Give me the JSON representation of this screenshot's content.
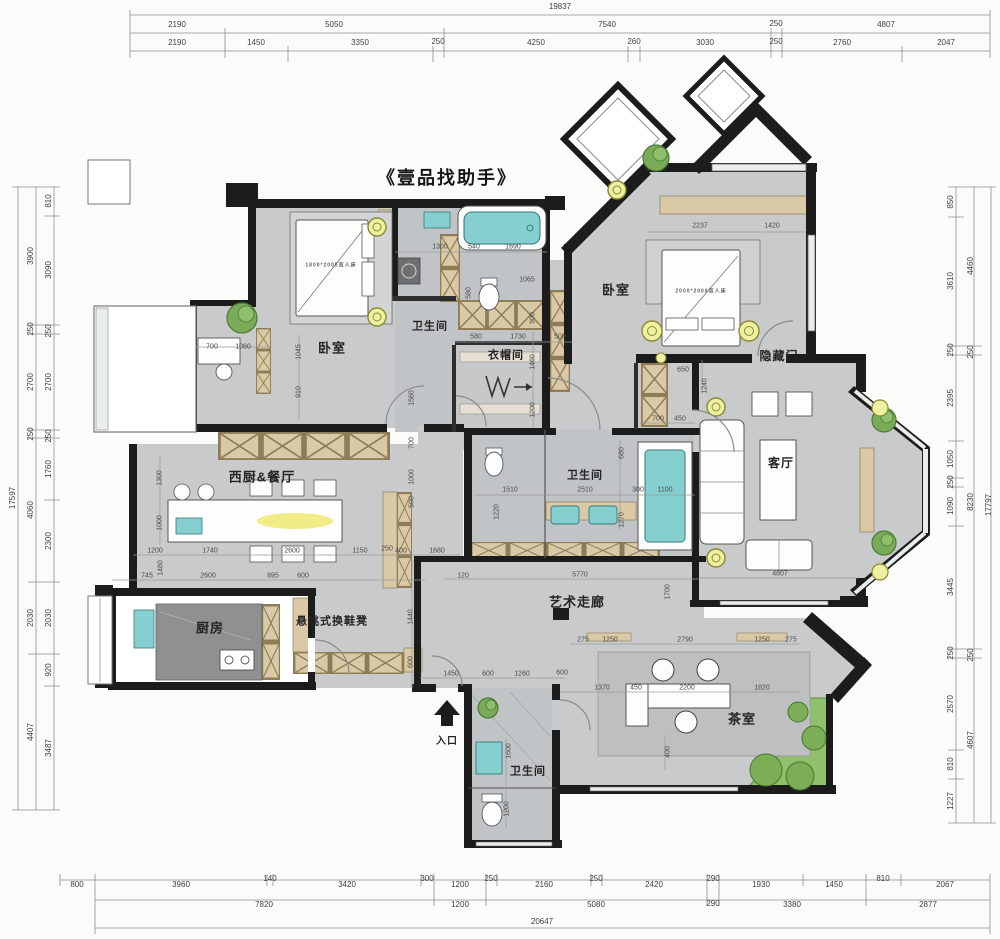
{
  "title": {
    "text": "《壹品找助手》"
  },
  "colors": {
    "wall": "#1c1c1c",
    "floor": "#c8cacb",
    "bath_floor": "#c0c4c6",
    "cabinet": "#d9c9a6",
    "fixture_teal": "#85d0cf",
    "lamp_yellow": "#eef0a2",
    "plant_green": "#79ab58",
    "garden_green": "#90c06c",
    "glow_yellow": "#f0eb7e"
  },
  "rooms": [
    {
      "t": "卧室",
      "x": 332,
      "y": 348,
      "fs": 13
    },
    {
      "t": "卫生间",
      "x": 430,
      "y": 327,
      "fs": 11
    },
    {
      "t": "衣帽间",
      "x": 506,
      "y": 356,
      "fs": 11
    },
    {
      "t": "卧室",
      "x": 616,
      "y": 290,
      "fs": 13
    },
    {
      "t": "隐藏门",
      "x": 779,
      "y": 356,
      "fs": 12
    },
    {
      "t": "客厅",
      "x": 781,
      "y": 463,
      "fs": 12
    },
    {
      "t": "卫生间",
      "x": 585,
      "y": 476,
      "fs": 11
    },
    {
      "t": "西厨&餐厅",
      "x": 262,
      "y": 477,
      "fs": 13
    },
    {
      "t": "厨房",
      "x": 210,
      "y": 628,
      "fs": 13
    },
    {
      "t": "悬挑式换鞋凳",
      "x": 332,
      "y": 622,
      "fs": 11
    },
    {
      "t": "艺术走廊",
      "x": 577,
      "y": 602,
      "fs": 13
    },
    {
      "t": "茶室",
      "x": 742,
      "y": 719,
      "fs": 13
    },
    {
      "t": "卫生间",
      "x": 528,
      "y": 772,
      "fs": 11
    },
    {
      "t": "入口",
      "x": 447,
      "y": 742,
      "fs": 10
    },
    {
      "t": "1800*2000双人床",
      "x": 331,
      "y": 266,
      "fs": 5,
      "c": "#5a5a5a"
    },
    {
      "t": "2000*2000双人床",
      "x": 701,
      "y": 292,
      "fs": 5,
      "c": "#5a5a5a"
    }
  ],
  "outer_dims": [
    {
      "t": "19837",
      "x": 560,
      "y": 7
    },
    {
      "t": "2190",
      "x": 177,
      "y": 25
    },
    {
      "t": "5050",
      "x": 334,
      "y": 25
    },
    {
      "t": "7540",
      "x": 607,
      "y": 25
    },
    {
      "t": "250",
      "x": 776,
      "y": 24
    },
    {
      "t": "4807",
      "x": 886,
      "y": 25
    },
    {
      "t": "2190",
      "x": 177,
      "y": 43
    },
    {
      "t": "1450",
      "x": 256,
      "y": 43
    },
    {
      "t": "3350",
      "x": 360,
      "y": 43
    },
    {
      "t": "250",
      "x": 438,
      "y": 42
    },
    {
      "t": "4250",
      "x": 536,
      "y": 43
    },
    {
      "t": "260",
      "x": 634,
      "y": 42
    },
    {
      "t": "3030",
      "x": 705,
      "y": 43
    },
    {
      "t": "250",
      "x": 776,
      "y": 42
    },
    {
      "t": "2760",
      "x": 842,
      "y": 43
    },
    {
      "t": "2047",
      "x": 946,
      "y": 43
    },
    {
      "t": "800",
      "x": 77,
      "y": 885
    },
    {
      "t": "3960",
      "x": 181,
      "y": 885
    },
    {
      "t": "140",
      "x": 270,
      "y": 879
    },
    {
      "t": "3420",
      "x": 347,
      "y": 885
    },
    {
      "t": "300",
      "x": 427,
      "y": 879
    },
    {
      "t": "1200",
      "x": 460,
      "y": 885
    },
    {
      "t": "250",
      "x": 491,
      "y": 879
    },
    {
      "t": "2160",
      "x": 544,
      "y": 885
    },
    {
      "t": "250",
      "x": 596,
      "y": 879
    },
    {
      "t": "2420",
      "x": 654,
      "y": 885
    },
    {
      "t": "290",
      "x": 713,
      "y": 879
    },
    {
      "t": "1930",
      "x": 761,
      "y": 885
    },
    {
      "t": "1450",
      "x": 834,
      "y": 885
    },
    {
      "t": "810",
      "x": 883,
      "y": 879
    },
    {
      "t": "2067",
      "x": 945,
      "y": 885
    },
    {
      "t": "7820",
      "x": 264,
      "y": 905
    },
    {
      "t": "1200",
      "x": 460,
      "y": 905
    },
    {
      "t": "5080",
      "x": 596,
      "y": 905
    },
    {
      "t": "290",
      "x": 713,
      "y": 904
    },
    {
      "t": "3380",
      "x": 792,
      "y": 905
    },
    {
      "t": "2877",
      "x": 928,
      "y": 905
    },
    {
      "t": "20647",
      "x": 542,
      "y": 922
    },
    {
      "t": "17597",
      "x": 13,
      "y": 498,
      "r": 1
    },
    {
      "t": "3900",
      "x": 31,
      "y": 256,
      "r": 1
    },
    {
      "t": "250",
      "x": 31,
      "y": 329,
      "r": 1
    },
    {
      "t": "2700",
      "x": 31,
      "y": 382,
      "r": 1
    },
    {
      "t": "250",
      "x": 31,
      "y": 434,
      "r": 1
    },
    {
      "t": "4060",
      "x": 31,
      "y": 510,
      "r": 1
    },
    {
      "t": "2030",
      "x": 31,
      "y": 618,
      "r": 1
    },
    {
      "t": "4407",
      "x": 31,
      "y": 732,
      "r": 1
    },
    {
      "t": "810",
      "x": 49,
      "y": 201,
      "r": 1
    },
    {
      "t": "3090",
      "x": 49,
      "y": 270,
      "r": 1
    },
    {
      "t": "250",
      "x": 49,
      "y": 331,
      "r": 1
    },
    {
      "t": "2700",
      "x": 49,
      "y": 382,
      "r": 1
    },
    {
      "t": "250",
      "x": 49,
      "y": 436,
      "r": 1
    },
    {
      "t": "1760",
      "x": 49,
      "y": 469,
      "r": 1
    },
    {
      "t": "2300",
      "x": 49,
      "y": 541,
      "r": 1
    },
    {
      "t": "2030",
      "x": 49,
      "y": 618,
      "r": 1
    },
    {
      "t": "920",
      "x": 49,
      "y": 670,
      "r": 1
    },
    {
      "t": "3487",
      "x": 49,
      "y": 748,
      "r": 1
    },
    {
      "t": "850",
      "x": 951,
      "y": 202,
      "r": 1
    },
    {
      "t": "3610",
      "x": 951,
      "y": 281,
      "r": 1
    },
    {
      "t": "250",
      "x": 951,
      "y": 350,
      "r": 1
    },
    {
      "t": "2395",
      "x": 951,
      "y": 398,
      "r": 1
    },
    {
      "t": "1050",
      "x": 951,
      "y": 459,
      "r": 1
    },
    {
      "t": "250",
      "x": 951,
      "y": 482,
      "r": 1
    },
    {
      "t": "1090",
      "x": 951,
      "y": 506,
      "r": 1
    },
    {
      "t": "3445",
      "x": 951,
      "y": 587,
      "r": 1
    },
    {
      "t": "250",
      "x": 951,
      "y": 653,
      "r": 1
    },
    {
      "t": "2570",
      "x": 951,
      "y": 704,
      "r": 1
    },
    {
      "t": "810",
      "x": 951,
      "y": 764,
      "r": 1
    },
    {
      "t": "1227",
      "x": 951,
      "y": 801,
      "r": 1
    },
    {
      "t": "4460",
      "x": 971,
      "y": 266,
      "r": 1
    },
    {
      "t": "250",
      "x": 971,
      "y": 352,
      "r": 1
    },
    {
      "t": "8230",
      "x": 971,
      "y": 502,
      "r": 1
    },
    {
      "t": "250",
      "x": 971,
      "y": 655,
      "r": 1
    },
    {
      "t": "4607",
      "x": 971,
      "y": 740,
      "r": 1
    },
    {
      "t": "17797",
      "x": 989,
      "y": 505,
      "r": 1
    }
  ],
  "inner_dims": [
    {
      "t": "700",
      "x": 212,
      "y": 347
    },
    {
      "t": "1060",
      "x": 243,
      "y": 347
    },
    {
      "t": "1045",
      "x": 299,
      "y": 352,
      "r": 1
    },
    {
      "t": "910",
      "x": 299,
      "y": 392,
      "r": 1
    },
    {
      "t": "1300",
      "x": 440,
      "y": 247
    },
    {
      "t": "540",
      "x": 474,
      "y": 247
    },
    {
      "t": "1690",
      "x": 513,
      "y": 247
    },
    {
      "t": "1065",
      "x": 527,
      "y": 280
    },
    {
      "t": "580",
      "x": 469,
      "y": 293,
      "r": 1
    },
    {
      "t": "580",
      "x": 476,
      "y": 337
    },
    {
      "t": "1730",
      "x": 518,
      "y": 337
    },
    {
      "t": "500",
      "x": 560,
      "y": 337
    },
    {
      "t": "900",
      "x": 533,
      "y": 318,
      "r": 1
    },
    {
      "t": "1460",
      "x": 533,
      "y": 362,
      "r": 1
    },
    {
      "t": "1200",
      "x": 533,
      "y": 410,
      "r": 1
    },
    {
      "t": "1560",
      "x": 412,
      "y": 398,
      "r": 1
    },
    {
      "t": "700",
      "x": 412,
      "y": 443,
      "r": 1
    },
    {
      "t": "1000",
      "x": 412,
      "y": 477,
      "r": 1
    },
    {
      "t": "500",
      "x": 412,
      "y": 502,
      "r": 1
    },
    {
      "t": "2237",
      "x": 700,
      "y": 226
    },
    {
      "t": "1420",
      "x": 772,
      "y": 226
    },
    {
      "t": "650",
      "x": 683,
      "y": 370
    },
    {
      "t": "1240",
      "x": 705,
      "y": 386,
      "r": 1
    },
    {
      "t": "700",
      "x": 658,
      "y": 419
    },
    {
      "t": "450",
      "x": 680,
      "y": 419
    },
    {
      "t": "680",
      "x": 622,
      "y": 453,
      "r": 1
    },
    {
      "t": "300",
      "x": 638,
      "y": 490
    },
    {
      "t": "1100",
      "x": 665,
      "y": 490
    },
    {
      "t": "1270",
      "x": 622,
      "y": 520,
      "r": 1
    },
    {
      "t": "2510",
      "x": 585,
      "y": 490
    },
    {
      "t": "1510",
      "x": 510,
      "y": 490
    },
    {
      "t": "1220",
      "x": 497,
      "y": 512,
      "r": 1
    },
    {
      "t": "1300",
      "x": 160,
      "y": 478,
      "r": 1
    },
    {
      "t": "1000",
      "x": 160,
      "y": 523,
      "r": 1
    },
    {
      "t": "1200",
      "x": 155,
      "y": 551
    },
    {
      "t": "1740",
      "x": 210,
      "y": 551
    },
    {
      "t": "2600",
      "x": 292,
      "y": 551
    },
    {
      "t": "1150",
      "x": 360,
      "y": 551
    },
    {
      "t": "250",
      "x": 387,
      "y": 549
    },
    {
      "t": "400",
      "x": 401,
      "y": 551
    },
    {
      "t": "1680",
      "x": 437,
      "y": 551
    },
    {
      "t": "1480",
      "x": 161,
      "y": 568,
      "r": 1
    },
    {
      "t": "745",
      "x": 147,
      "y": 576
    },
    {
      "t": "2600",
      "x": 208,
      "y": 576
    },
    {
      "t": "895",
      "x": 273,
      "y": 576
    },
    {
      "t": "600",
      "x": 303,
      "y": 576
    },
    {
      "t": "1440",
      "x": 411,
      "y": 617,
      "r": 1
    },
    {
      "t": "600",
      "x": 411,
      "y": 662,
      "r": 1
    },
    {
      "t": "120",
      "x": 463,
      "y": 576
    },
    {
      "t": "5770",
      "x": 580,
      "y": 575
    },
    {
      "t": "1700",
      "x": 668,
      "y": 592,
      "r": 1
    },
    {
      "t": "275",
      "x": 583,
      "y": 640
    },
    {
      "t": "1250",
      "x": 610,
      "y": 640
    },
    {
      "t": "2790",
      "x": 685,
      "y": 640
    },
    {
      "t": "1250",
      "x": 762,
      "y": 640
    },
    {
      "t": "275",
      "x": 791,
      "y": 640
    },
    {
      "t": "1450",
      "x": 451,
      "y": 674
    },
    {
      "t": "600",
      "x": 488,
      "y": 674
    },
    {
      "t": "1260",
      "x": 522,
      "y": 674
    },
    {
      "t": "600",
      "x": 562,
      "y": 673
    },
    {
      "t": "1370",
      "x": 602,
      "y": 688
    },
    {
      "t": "450",
      "x": 636,
      "y": 688
    },
    {
      "t": "2200",
      "x": 687,
      "y": 688
    },
    {
      "t": "1820",
      "x": 762,
      "y": 688
    },
    {
      "t": "400",
      "x": 668,
      "y": 752,
      "r": 1
    },
    {
      "t": "1600",
      "x": 509,
      "y": 751,
      "r": 1
    },
    {
      "t": "1200",
      "x": 507,
      "y": 809,
      "r": 1
    },
    {
      "t": "4807",
      "x": 780,
      "y": 574
    }
  ]
}
